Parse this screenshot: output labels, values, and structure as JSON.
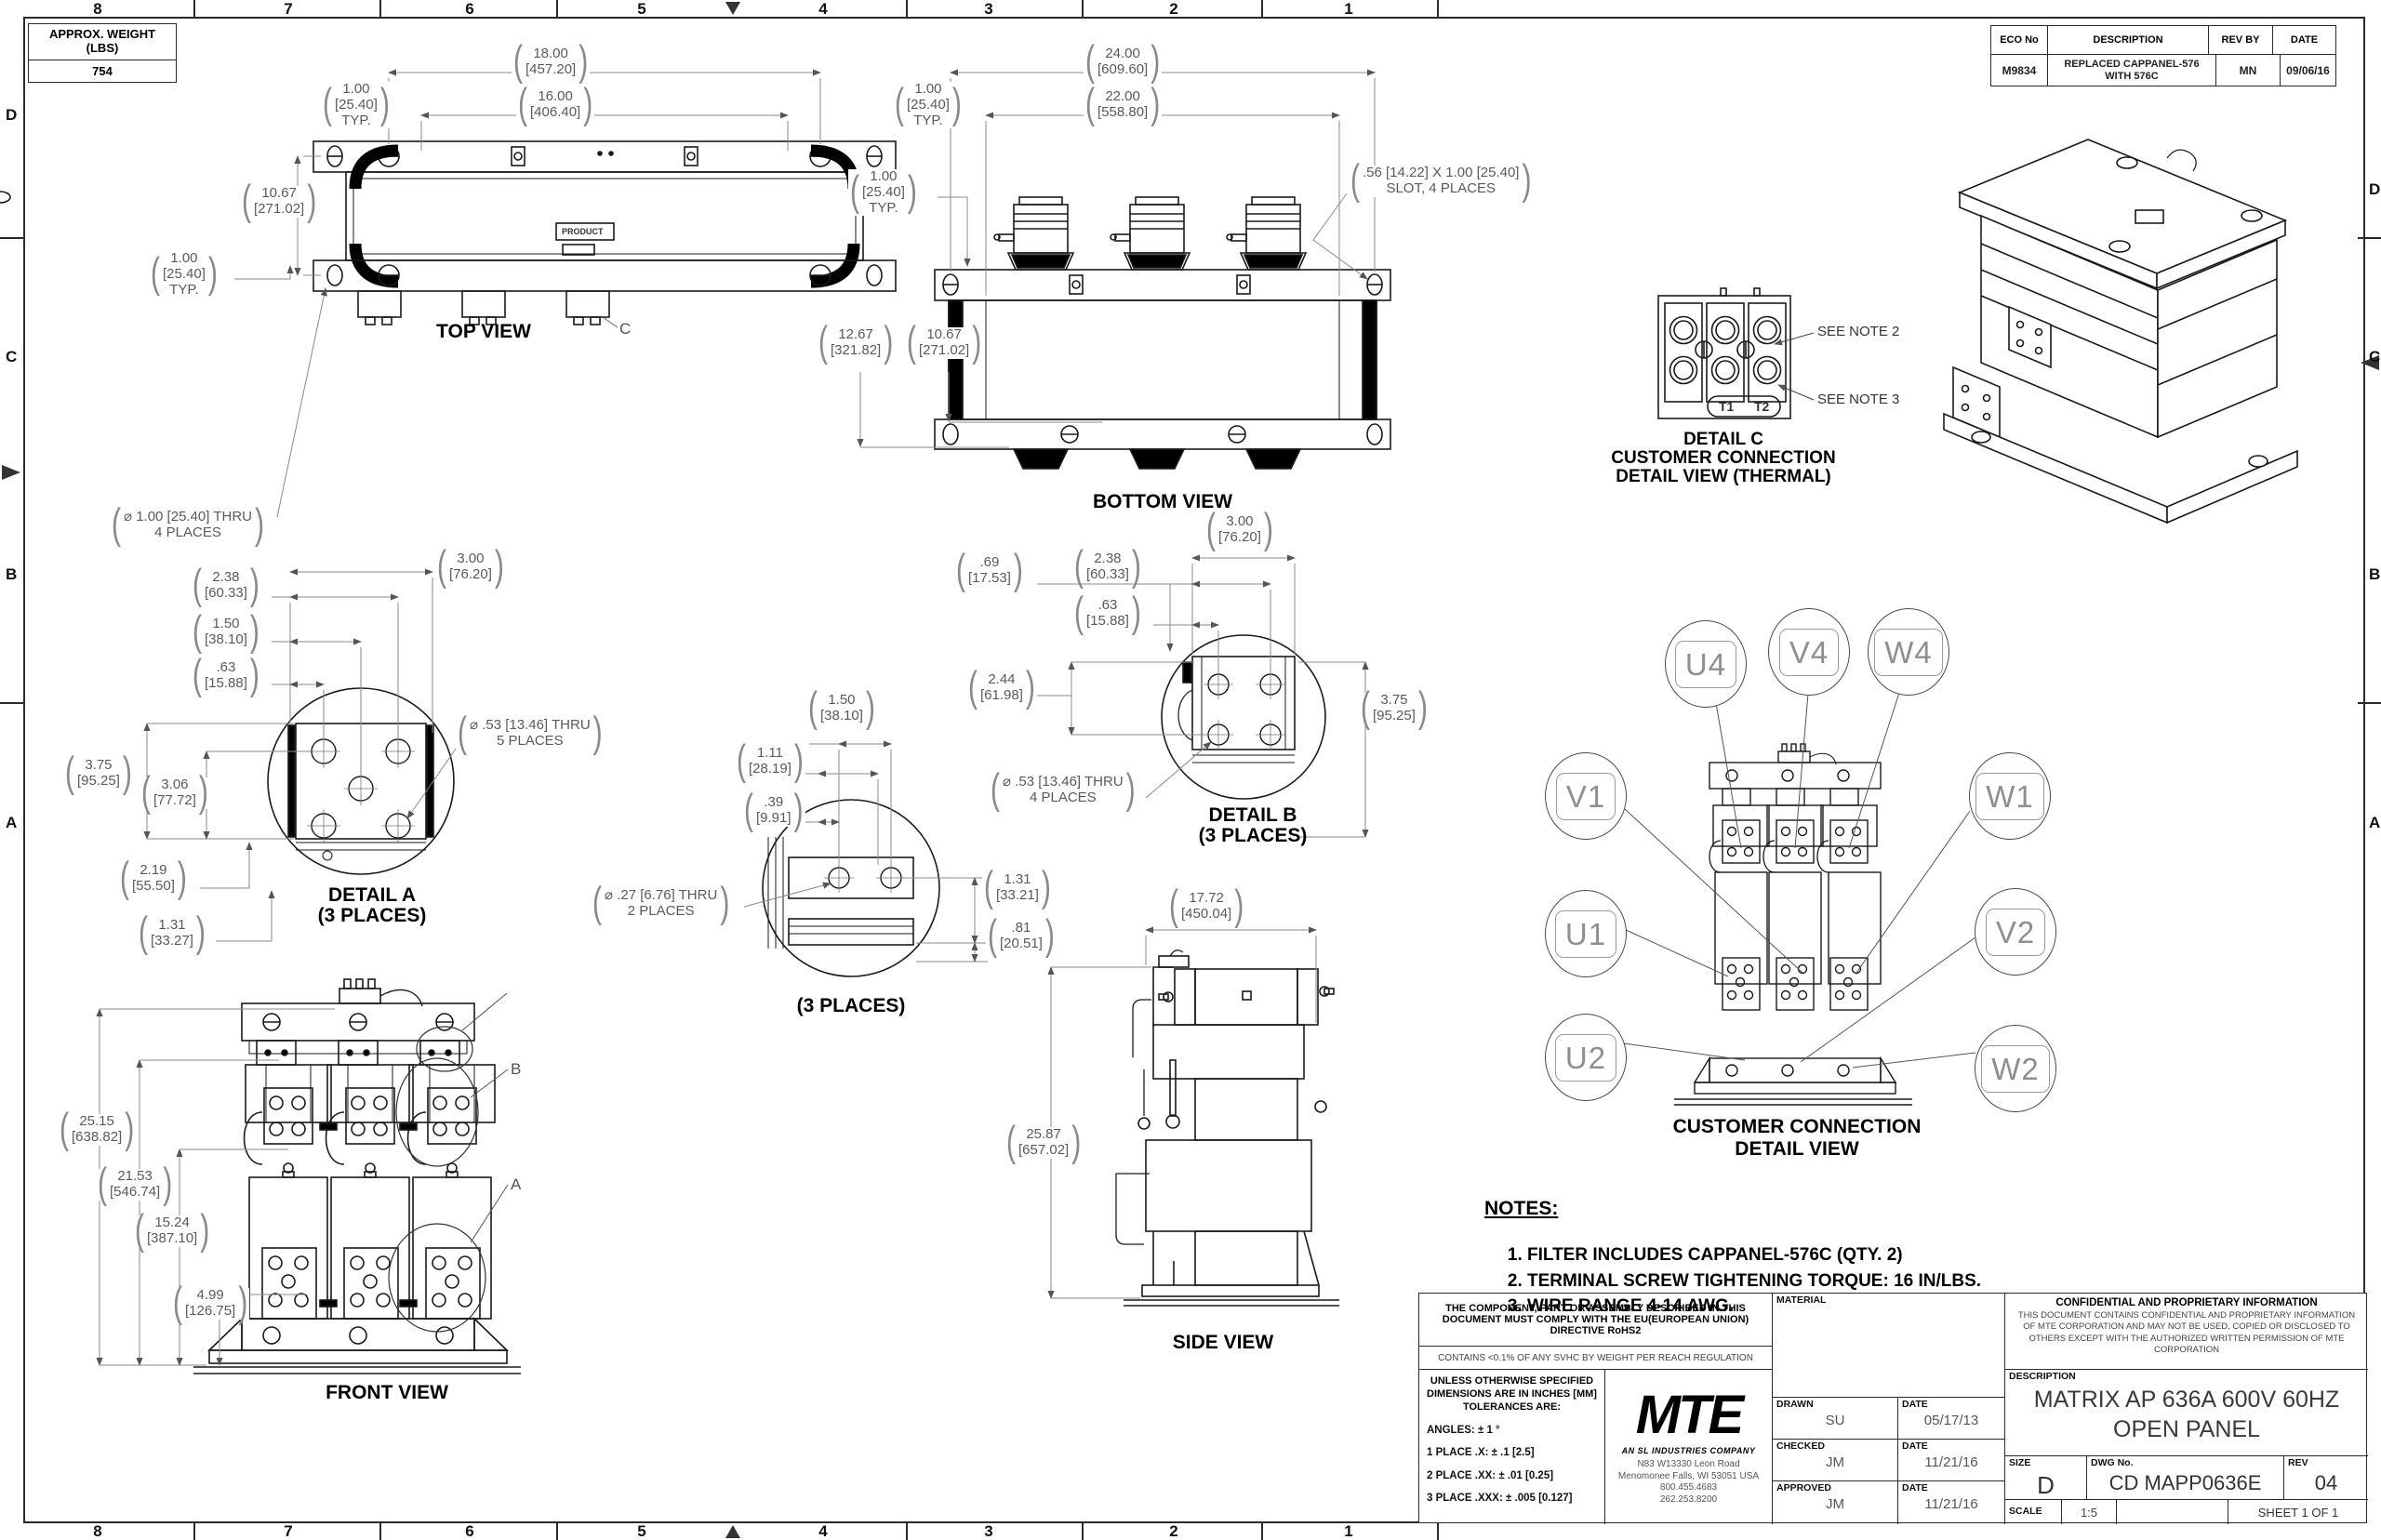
{
  "frame": {
    "zones": [
      "8",
      "7",
      "6",
      "5",
      "4",
      "3",
      "2",
      "1"
    ],
    "rows": [
      "D",
      "C",
      "B",
      "A"
    ]
  },
  "weight_table": {
    "title_line1": "APPROX. WEIGHT",
    "title_line2": "(LBS)",
    "value": "754"
  },
  "eco_table": {
    "h_eco": "ECO No",
    "h_desc": "DESCRIPTION",
    "h_rev": "REV BY",
    "h_date": "DATE",
    "eco": "M9834",
    "desc": "REPLACED CAPPANEL-576 WITH 576C",
    "rev": "MN",
    "date": "09/06/16"
  },
  "view_titles": {
    "top": "TOP VIEW",
    "bottom": "BOTTOM VIEW",
    "front": "FRONT VIEW",
    "side": "SIDE VIEW",
    "detail_a1": "DETAIL A",
    "detail_a2": "(3 PLACES)",
    "detail_b1": "DETAIL B",
    "detail_b2": "(3 PLACES)",
    "detail_c1": "DETAIL C",
    "detail_c2": "CUSTOMER CONNECTION",
    "detail_c3": "DETAIL VIEW (THERMAL)",
    "mid_detail": "(3 PLACES)",
    "cc1": "CUSTOMER CONNECTION",
    "cc2": "DETAIL VIEW"
  },
  "labels": {
    "product": "PRODUCT",
    "t1": "T1",
    "t2": "T2",
    "see_note2": "SEE NOTE 2",
    "see_note3": "SEE NOTE 3",
    "callout_a": "A",
    "callout_b": "B",
    "callout_c": "C"
  },
  "cc_balloons": [
    "U4",
    "V4",
    "W4",
    "V1",
    "U1",
    "U2",
    "W1",
    "V2",
    "W2"
  ],
  "dims": {
    "tv18": {
      "in": "18.00",
      "mm": "[457.20]"
    },
    "tv16": {
      "in": "16.00",
      "mm": "[406.40]"
    },
    "tv1t": {
      "in": "1.00",
      "mm": "[25.40]",
      "note": "TYP."
    },
    "tv1067": {
      "in": "10.67",
      "mm": "[271.02]"
    },
    "tv1l": {
      "in": "1.00",
      "mm": "[25.40]",
      "note": "TYP."
    },
    "tvhole": {
      "line1": "⌀ 1.00 [25.40] THRU",
      "line2": "4 PLACES"
    },
    "bv24": {
      "in": "24.00",
      "mm": "[609.60]"
    },
    "bv22": {
      "in": "22.00",
      "mm": "[558.80]"
    },
    "bv1t": {
      "in": "1.00",
      "mm": "[25.40]",
      "note": "TYP."
    },
    "bv1l": {
      "in": "1.00",
      "mm": "[25.40]",
      "note": "TYP."
    },
    "bvslot": {
      "line1": ".56 [14.22] X 1.00 [25.40]",
      "line2": "SLOT, 4 PLACES"
    },
    "bv1267": {
      "in": "12.67",
      "mm": "[321.82]"
    },
    "bv1067": {
      "in": "10.67",
      "mm": "[271.02]"
    },
    "da238": {
      "in": "2.38",
      "mm": "[60.33]"
    },
    "da150": {
      "in": "1.50",
      "mm": "[38.10]"
    },
    "da63": {
      "in": ".63",
      "mm": "[15.88]"
    },
    "da300": {
      "in": "3.00",
      "mm": "[76.20]"
    },
    "da375": {
      "in": "3.75",
      "mm": "[95.25]"
    },
    "da306": {
      "in": "3.06",
      "mm": "[77.72]"
    },
    "da219": {
      "in": "2.19",
      "mm": "[55.50]"
    },
    "da131": {
      "in": "1.31",
      "mm": "[33.27]"
    },
    "dahole": {
      "line1": "⌀ .53 [13.46] THRU",
      "line2": "5 PLACES"
    },
    "md150": {
      "in": "1.50",
      "mm": "[38.10]"
    },
    "md111": {
      "in": "1.11",
      "mm": "[28.19]"
    },
    "md39": {
      "in": ".39",
      "mm": "[9.91]"
    },
    "mdhole": {
      "line1": "⌀ .27 [6.76] THRU",
      "line2": "2 PLACES"
    },
    "md131": {
      "in": "1.31",
      "mm": "[33.21]"
    },
    "md81": {
      "in": ".81",
      "mm": "[20.51]"
    },
    "db300": {
      "in": "3.00",
      "mm": "[76.20]"
    },
    "db238": {
      "in": "2.38",
      "mm": "[60.33]"
    },
    "db63": {
      "in": ".63",
      "mm": "[15.88]"
    },
    "db69": {
      "in": ".69",
      "mm": "[17.53]"
    },
    "db244": {
      "in": "2.44",
      "mm": "[61.98]"
    },
    "db375": {
      "in": "3.75",
      "mm": "[95.25]"
    },
    "dbhole": {
      "line1": "⌀ .53 [13.46] THRU",
      "line2": "4 PLACES"
    },
    "fv2515": {
      "in": "25.15",
      "mm": "[638.82]"
    },
    "fv2153": {
      "in": "21.53",
      "mm": "[546.74]"
    },
    "fv1524": {
      "in": "15.24",
      "mm": "[387.10]"
    },
    "fv499": {
      "in": "4.99",
      "mm": "[126.75]"
    },
    "sv1772": {
      "in": "17.72",
      "mm": "[450.04]"
    },
    "sv2587": {
      "in": "25.87",
      "mm": "[657.02]"
    }
  },
  "notes": {
    "title": "NOTES:",
    "items": [
      "FILTER INCLUDES CAPPANEL-576C (QTY. 2)",
      "TERMINAL SCREW TIGHTENING TORQUE: 16 IN/LBS.",
      "WIRE RANGE 4-14 AWG."
    ]
  },
  "title_block": {
    "compliance": "THE COMPONENT, PART OR ASSEMBLY DESCRIBED IN THIS DOCUMENT MUST COMPLY WITH THE EU(EUROPEAN UNION) DIRECTIVE RoHS2",
    "reach": "CONTAINS <0.1% OF ANY SVHC BY WEIGHT PER REACH REGULATION",
    "tol_header1": "UNLESS OTHERWISE SPECIFIED",
    "tol_header2": "DIMENSIONS ARE IN INCHES [MM]",
    "tol_header3": "TOLERANCES ARE:",
    "tol_angles": "ANGLES: ± 1 °",
    "tol_1": "1 PLACE .X: ± .1 [2.5]",
    "tol_2": "2 PLACE .XX: ± .01 [0.25]",
    "tol_3": "3 PLACE .XXX: ± .005 [0.127]",
    "logo_text": "MTE",
    "logo_sub": "AN SL INDUSTRIES COMPANY",
    "address_1": "N83 W13330 Leon Road",
    "address_2": "Menomonee Falls, WI 53051 USA",
    "address_3": "800.455.4683",
    "address_4": "262.253.8200",
    "material_label": "MATERIAL",
    "drawn_label": "DRAWN",
    "drawn_value": "SU",
    "date_label": "DATE",
    "drawn_date": "05/17/13",
    "checked_label": "CHECKED",
    "checked_value": "JM",
    "checked_date": "11/21/16",
    "approved_label": "APPROVED",
    "approved_value": "JM",
    "approved_date": "11/21/16",
    "confidential_title": "CONFIDENTIAL AND PROPRIETARY INFORMATION",
    "confidential_body": "THIS DOCUMENT CONTAINS CONFIDENTIAL AND PROPRIETARY INFORMATION OF MTE CORPORATION AND MAY NOT BE USED, COPIED OR DISCLOSED TO OTHERS EXCEPT WITH THE AUTHORIZED WRITTEN PERMISSION OF MTE CORPORATION",
    "description_label": "DESCRIPTION",
    "description_line1": "MATRIX AP 636A 600V 60HZ",
    "description_line2": "OPEN PANEL",
    "size_label": "SIZE",
    "size_value": "D",
    "dwg_label": "DWG No.",
    "dwg_value": "CD MAPP0636E",
    "rev_label": "REV",
    "rev_value": "04",
    "scale_label": "SCALE",
    "scale_value": "1:5",
    "sheet_value": "SHEET 1  OF 1"
  }
}
